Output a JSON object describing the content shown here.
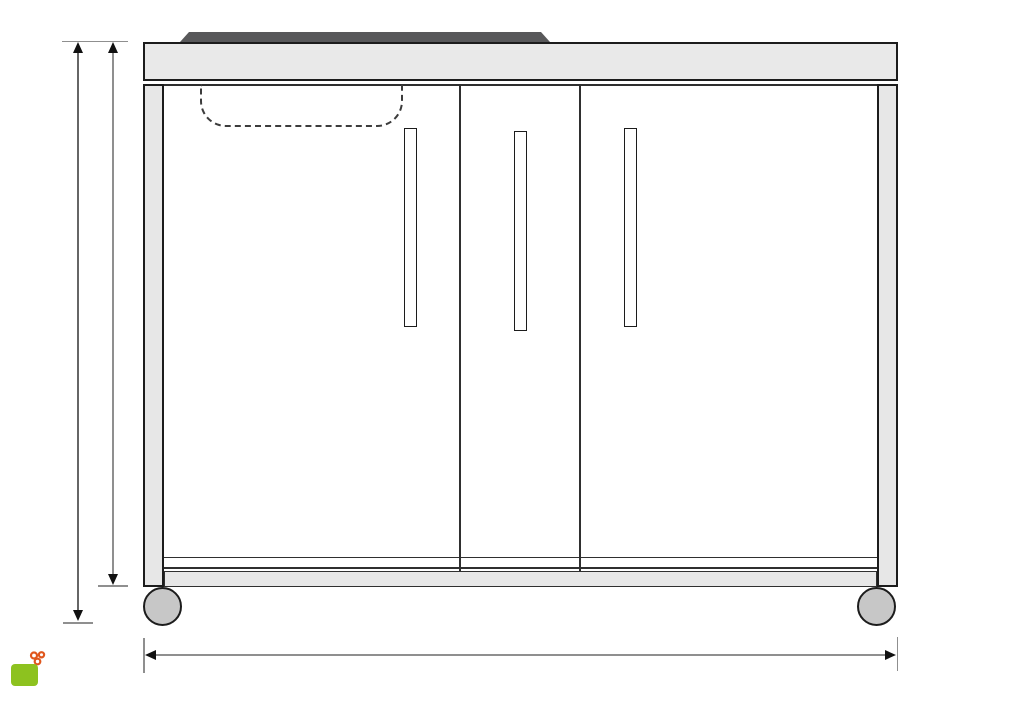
{
  "drawing": {
    "subject": "mobile-kitchen-cabinet-front-elevation",
    "dimension_labels": {
      "overall_height": "98 cm",
      "body_height": "92 cm",
      "overall_width": "127 cm"
    },
    "door_count": 3,
    "vent_dash_count": 10,
    "colors": {
      "outline": "#1c1c1c",
      "panel_fill": "#e7e7e7",
      "counter_fill": "#e9e9e9",
      "hob_fill": "#58585a",
      "wheel_fill": "#c7c7c7",
      "dimension_line": "#8f8f8f"
    }
  },
  "logo": {
    "tagline": "Mon Aménagement",
    "brand": "JARDIN",
    "monogram": "ma",
    "website": "www.monamenagementjardin.fr",
    "colors": {
      "orange": "#e0571d",
      "green": "#8dc21f",
      "url_green": "#a3c46d"
    }
  }
}
